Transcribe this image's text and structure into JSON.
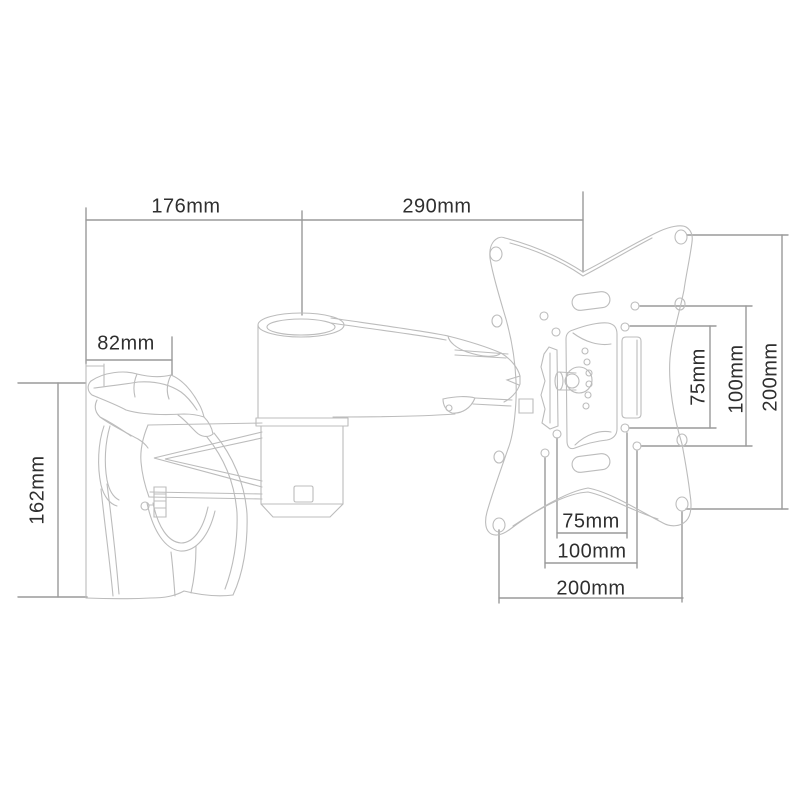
{
  "drawing": {
    "subject": "Articulating TV wall mount bracket - technical dimension drawing",
    "background": "#ffffff",
    "colors": {
      "object_line": "#bcbcbc",
      "dimension_line": "#9a9a9a",
      "text": "#2f2f2f"
    },
    "dimensions": {
      "arm_depth": "176mm",
      "plate_reach": "290mm",
      "clamp_depth": "82mm",
      "bracket_height": "162mm",
      "vesa_vertical_75": "75mm",
      "vesa_vertical_100": "100mm",
      "vesa_vertical_200": "200mm",
      "vesa_horizontal_75": "75mm",
      "vesa_horizontal_100": "100mm",
      "vesa_horizontal_200": "200mm"
    }
  }
}
